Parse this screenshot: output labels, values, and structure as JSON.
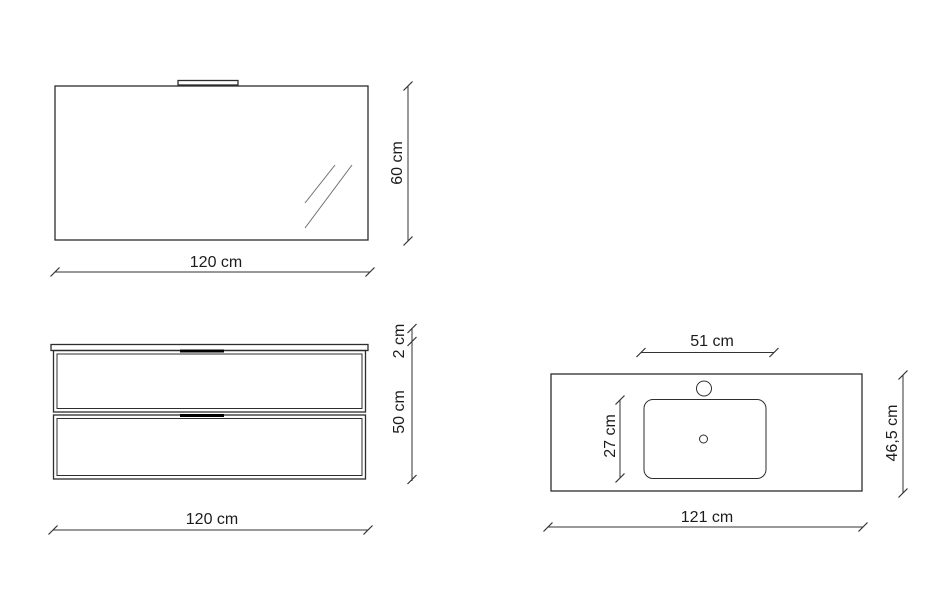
{
  "drawing": {
    "background": "#ffffff",
    "outline_color": "#2d2d2d",
    "dimension_color": "#333333",
    "glint_color": "#6e6e6e",
    "handle_color": "#000000",
    "mirror_view": {
      "width_dim": "120 cm",
      "height_dim": "60 cm"
    },
    "cabinet_view": {
      "top_thickness_dim": "2 cm",
      "body_height_dim": "50 cm",
      "width_dim": "120 cm"
    },
    "worktop_view": {
      "basin_width_dim": "51 cm",
      "basin_depth_dim": "27 cm",
      "depth_dim": "46,5 cm",
      "width_dim": "121 cm"
    }
  }
}
